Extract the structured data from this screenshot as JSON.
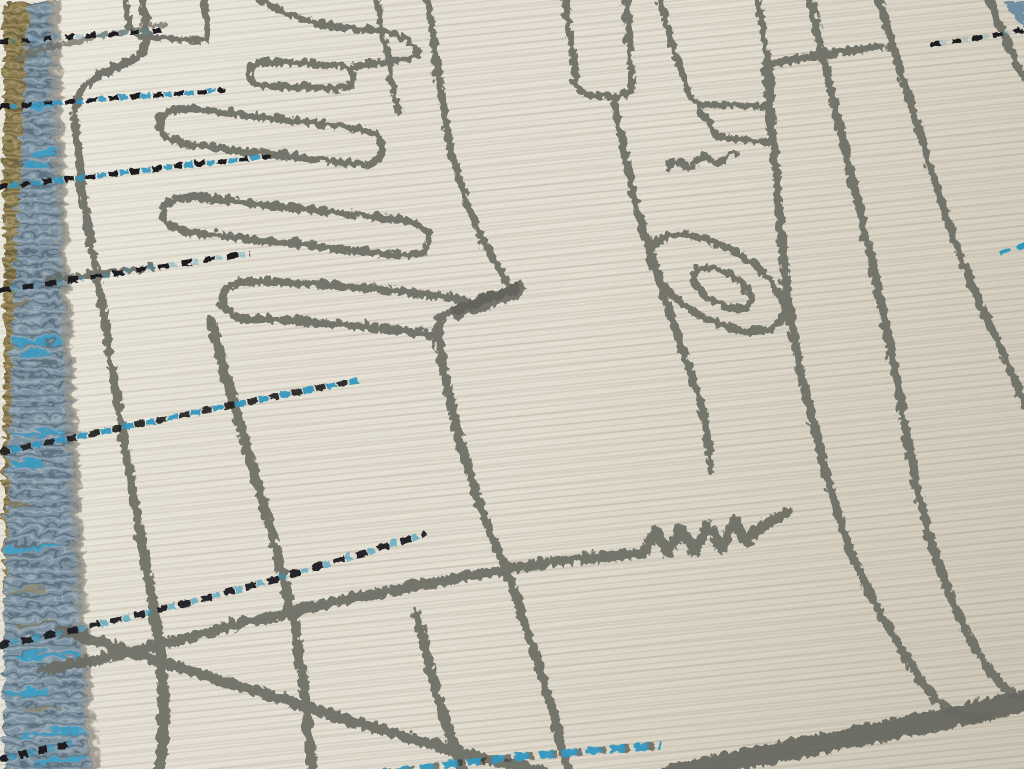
{
  "meta": {
    "domain": "natural-image",
    "subject": "rug-photograph",
    "description": "Angled close-up photograph of a cream hand-knotted wool rug with abstract charcoal line motifs, dashed black-and-blue weft lines, and a blue-gray flatwoven selvage with tan fringe along the left edge."
  },
  "palette": {
    "field_ivory": "#e4dfd2",
    "line_gray": "#6a6b62",
    "line_dark": "#565750",
    "band_gray": "#5d5f57",
    "dash_black": "#17181a",
    "dash_blue": "#2f96c0",
    "selvage_blue": "#7b91a0",
    "selvage_blue_bright": "#35a0ca",
    "selvage_shadow": "#5f7484",
    "selvage_light": "#a8b6bd",
    "fringe_tan": "#8b7b50",
    "corner_blue": "#6e8ea2",
    "pile_shadow": "#9b958a"
  },
  "scene": {
    "caption": "Cream wool rug with charcoal abstract comb and loop motifs, blue and black dashed weft stripes, and a blue flatwoven selvage edge with tan fringe on the left.",
    "elements": [
      {
        "name": "rug-field",
        "description": "Ivory knotted pile with fine horizontal weave rows rising slightly to the right"
      },
      {
        "name": "fringe-strip",
        "description": "Tan flatweave fringe along the far left edge, widest at top"
      },
      {
        "name": "selvage-band",
        "description": "Steel-blue mottled flatwoven side band widening toward the bottom, with bright azure streaks"
      },
      {
        "name": "comb-motif",
        "description": "Charcoal comb or hand shape with rounded finger capsules pointing left"
      },
      {
        "name": "loop-motif",
        "description": "Elongated tilted oval loop outline with a smaller oval inside"
      },
      {
        "name": "zigzag-motif",
        "description": "Small W zigzag joined to a long horizontal line near bottom center"
      },
      {
        "name": "dashed-weft-lines",
        "description": "Dashed lines of alternating black and azure knots running across the field"
      },
      {
        "name": "thick-end-band",
        "description": "Thick charcoal border band crossing the bottom right corner"
      },
      {
        "name": "corner-selvage",
        "description": "Small blue selvage wedge at the top right corner"
      }
    ]
  }
}
